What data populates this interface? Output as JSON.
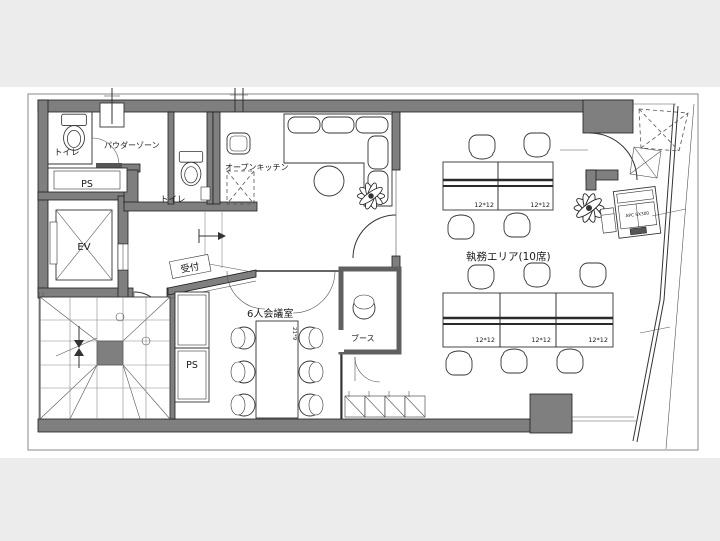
{
  "plan": {
    "colors": {
      "background": "#ececec",
      "paper": "#ffffff",
      "wall": "#7f7f7f",
      "line": "#333333"
    },
    "rooms": {
      "toilet_1": "トイレ",
      "powder_zone": "パウダーゾーン",
      "pipe_space_1": "PS",
      "elevator": "EV",
      "toilet_2": "トイレ",
      "open_kitchen": "オープンキッチン",
      "reception": "受付",
      "meeting_room": "6人会議室",
      "pipe_space_2": "PS",
      "booth": "ブース",
      "work_area": "執務エリア(10席)"
    },
    "annotations": {
      "desk_size": "12*12",
      "meeting_table_size": "21*9",
      "equipment": "APC SX300"
    }
  }
}
